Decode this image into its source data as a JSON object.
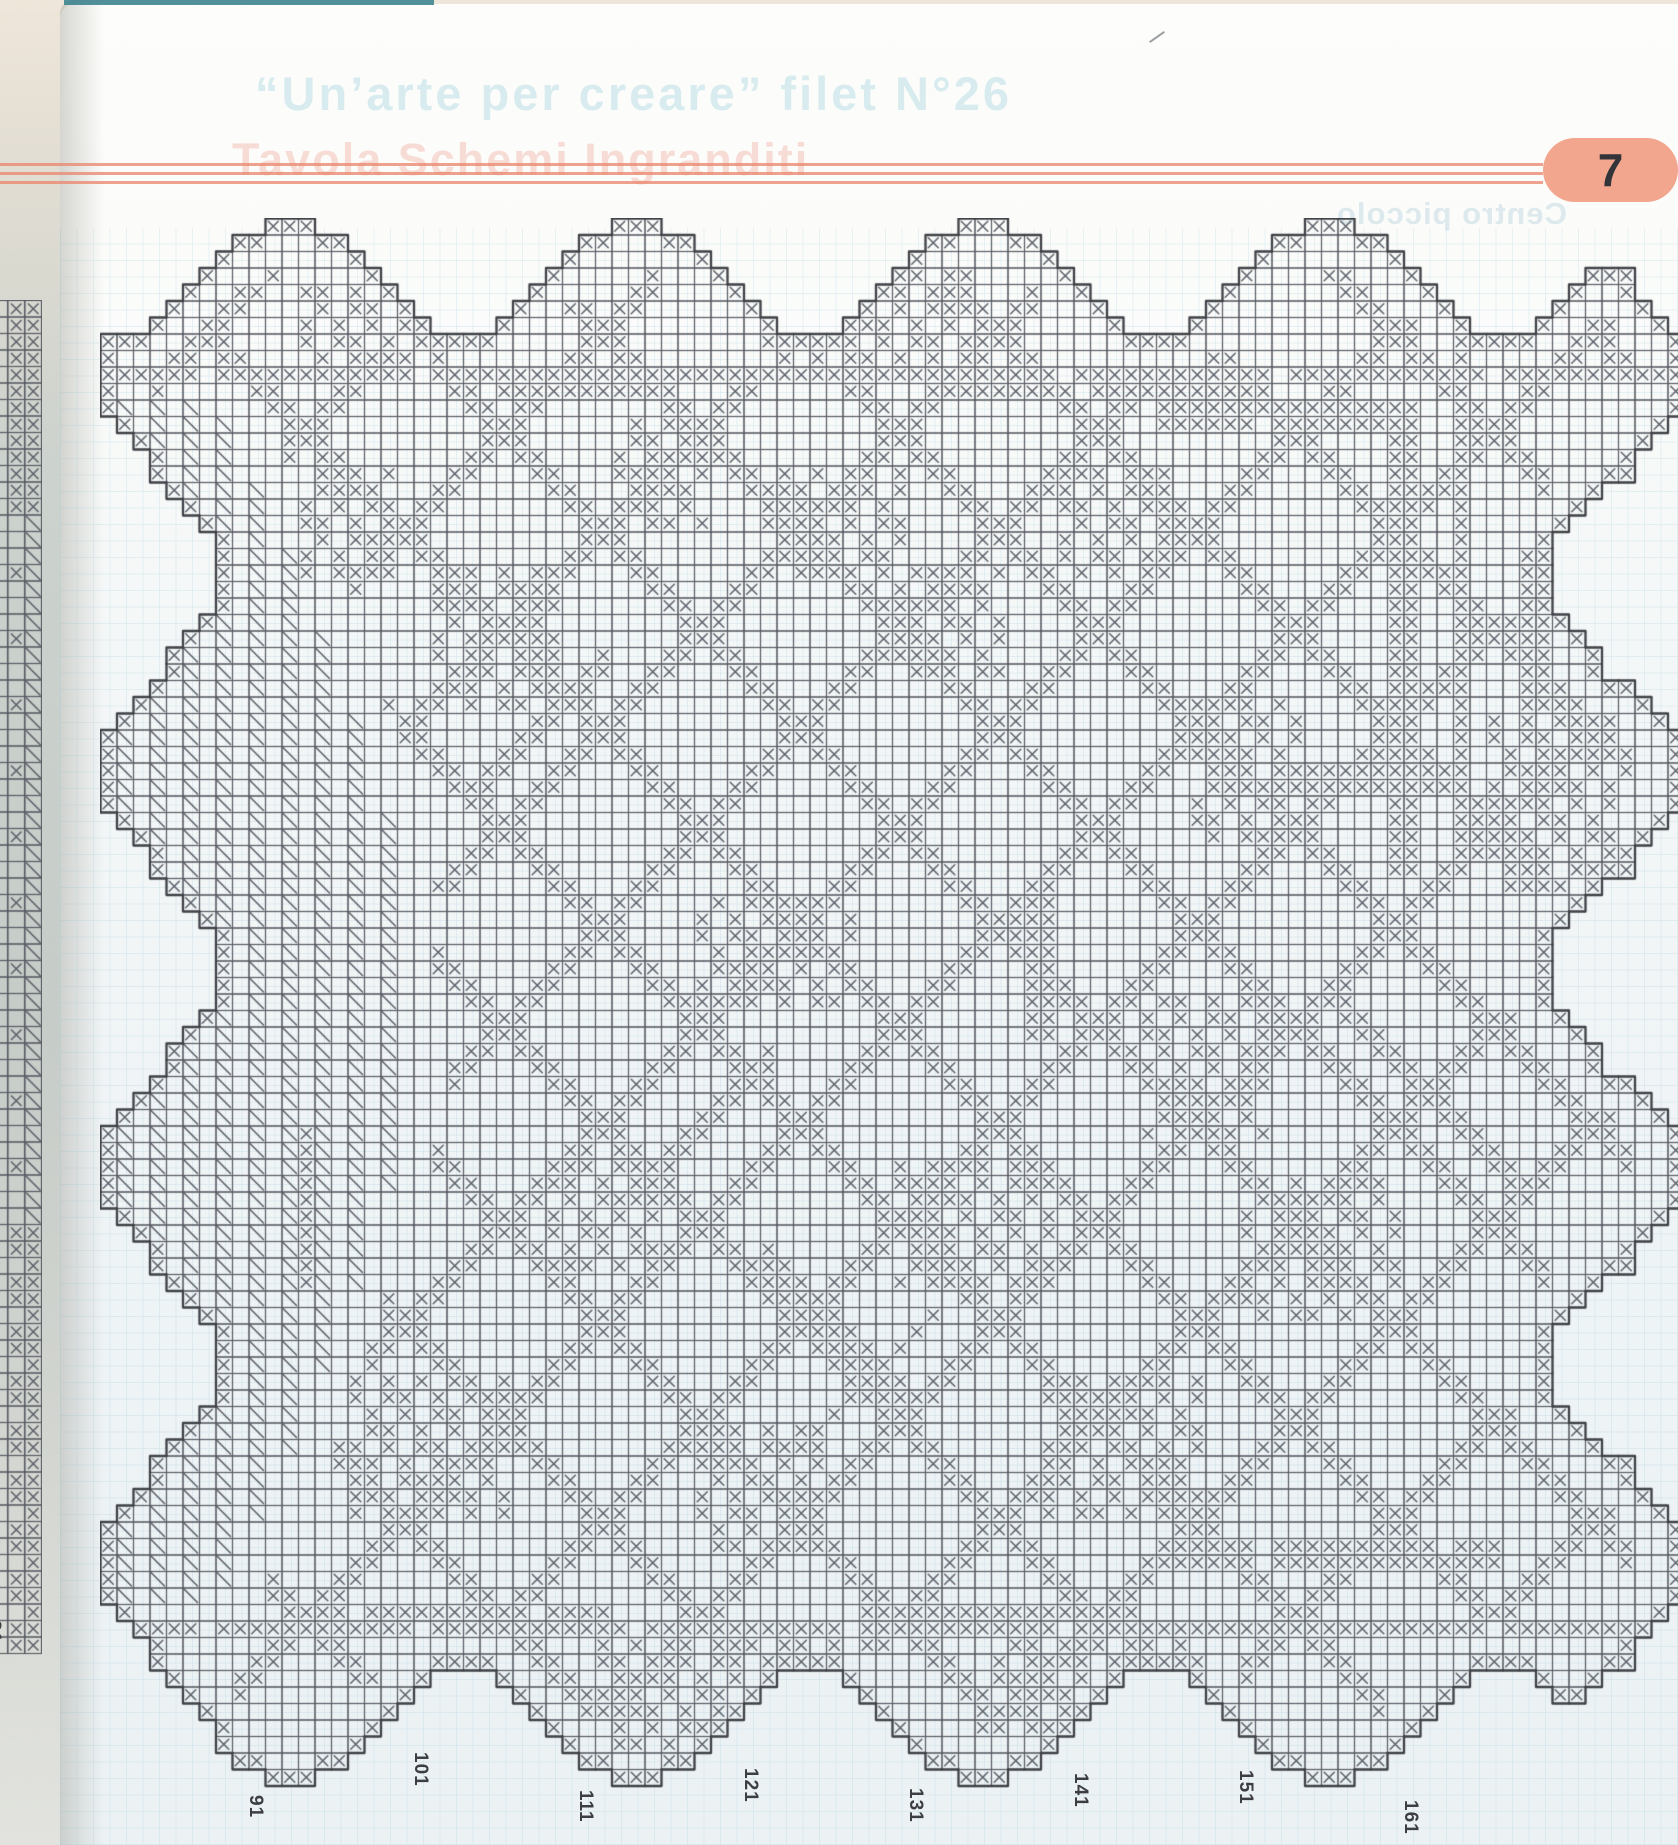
{
  "page": {
    "number_label": "7"
  },
  "header": {
    "ghost_title": "“Un’arte per creare” filet N°26",
    "ghost_subtitle": "Tavola Schemi Ingranditi",
    "ghost_mirrored": "Centro piccolo",
    "rule_color": "#ea8a70",
    "rule_y": [
      163,
      172,
      181
    ],
    "rule_end_x": 1543
  },
  "badge": {
    "label": "7",
    "bg": "#f3a68e",
    "fg": "#33343a"
  },
  "chart": {
    "columns": 96,
    "rows": 95,
    "cell_px": 16.5,
    "origin_x": 100,
    "origin_y": 218,
    "col_start_number": 82,
    "bottom_labels": [
      {
        "text": "91",
        "y": 1795
      },
      {
        "text": "101",
        "y": 1752
      },
      {
        "text": "111",
        "y": 1790
      },
      {
        "text": "121",
        "y": 1768
      },
      {
        "text": "131",
        "y": 1788
      },
      {
        "text": "141",
        "y": 1773
      },
      {
        "text": "151",
        "y": 1770
      },
      {
        "text": "161",
        "y": 1800
      }
    ],
    "scallop": {
      "period_cols": 21,
      "center_col": 11,
      "height_rows": 7,
      "period_rows": 24,
      "center_row": 9,
      "depth_cols": 7
    },
    "bands": {
      "top_row": 9,
      "bottom_row": 85,
      "gap_mod": 13,
      "gap_val": 6,
      "extra_segments": [
        {
          "row": 10,
          "c1": 24,
          "c2": 34
        },
        {
          "row": 10,
          "c1": 52,
          "c2": 68
        },
        {
          "row": 84,
          "c1": 12,
          "c2": 30
        },
        {
          "row": 84,
          "c1": 46,
          "c2": 62
        },
        {
          "row": 80,
          "c1": 64,
          "c2": 84
        },
        {
          "row": 81,
          "c1": 64,
          "c2": 84
        },
        {
          "row": 11,
          "c1": 64,
          "c2": 79
        },
        {
          "row": 12,
          "c1": 64,
          "c2": 79
        },
        {
          "row": 33,
          "c1": 68,
          "c2": 80
        },
        {
          "row": 34,
          "c1": 68,
          "c2": 80
        }
      ]
    },
    "fan": {
      "c_min": 1,
      "r_min": 11,
      "r_max": 83,
      "base_width": 6,
      "amp": 12
    },
    "lattice": {
      "mod": 12,
      "thick": 2,
      "margin": 3
    },
    "clusters": [
      [
        4,
        12,
        9,
        20
      ],
      [
        3,
        40,
        8,
        52
      ],
      [
        15,
        12,
        21,
        17
      ],
      [
        21,
        20,
        29,
        27
      ],
      [
        12,
        31,
        18,
        36
      ],
      [
        15,
        40,
        21,
        48
      ],
      [
        21,
        48,
        27,
        54
      ],
      [
        15,
        58,
        21,
        64
      ],
      [
        29,
        66,
        37,
        72
      ],
      [
        41,
        36,
        47,
        45
      ],
      [
        57,
        27,
        63,
        33
      ],
      [
        57,
        48,
        64,
        57
      ],
      [
        47,
        63,
        55,
        70
      ],
      [
        70,
        15,
        78,
        24
      ],
      [
        73,
        36,
        80,
        43
      ],
      [
        70,
        57,
        78,
        66
      ],
      [
        58,
        69,
        66,
        78
      ],
      [
        86,
        30,
        92,
        44
      ],
      [
        86,
        54,
        91,
        66
      ],
      [
        30,
        84,
        40,
        91
      ]
    ],
    "runs": [
      {
        "r": 12,
        "c": 78,
        "len": 28,
        "dir": "v",
        "w": 2
      },
      {
        "r": 2,
        "c": 82,
        "len": 38,
        "dir": "v",
        "w": 1
      },
      {
        "r": 44,
        "c": 20,
        "len": 10,
        "dir": "d1",
        "w": 2
      },
      {
        "r": 50,
        "c": 40,
        "len": 9,
        "dir": "d2",
        "w": 2
      },
      {
        "r": 62,
        "c": 40,
        "len": 9,
        "dir": "d1",
        "w": 2
      },
      {
        "r": 26,
        "c": 30,
        "len": 8,
        "dir": "d2",
        "w": 2
      },
      {
        "r": 66,
        "c": 50,
        "len": 9,
        "dir": "d2",
        "w": 1
      },
      {
        "r": 40,
        "c": 56,
        "len": 10,
        "dir": "v",
        "w": 2
      },
      {
        "r": 55,
        "c": 12,
        "len": 10,
        "dir": "v",
        "w": 1
      },
      {
        "r": 46,
        "c": 74,
        "len": 12,
        "dir": "d1",
        "w": 2
      },
      {
        "r": 20,
        "c": 86,
        "len": 10,
        "dir": "v",
        "w": 2
      }
    ],
    "colors": {
      "line": "#565962",
      "mark": "#5a5d66",
      "edge": "#3e4046",
      "paper_grid": "#82b9d2"
    }
  },
  "side_chart": {
    "label": "81",
    "rows": 82
  }
}
